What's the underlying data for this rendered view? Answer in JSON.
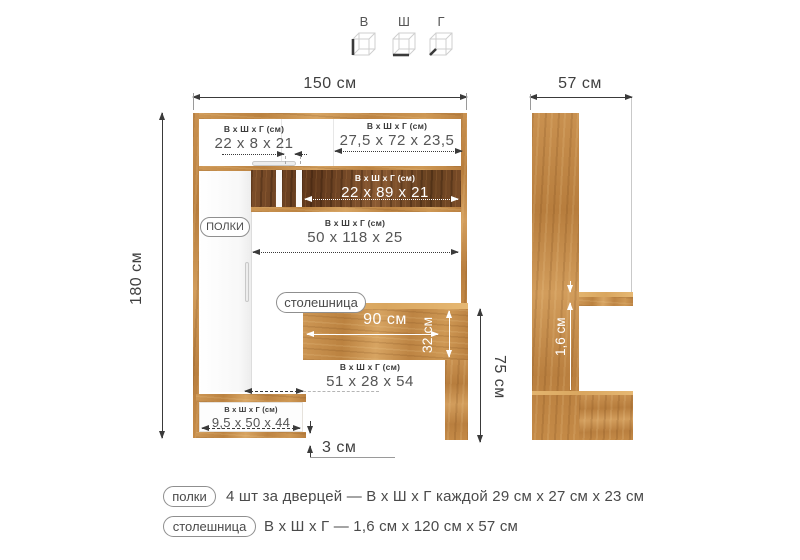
{
  "axis_icons": {
    "height": "В",
    "width": "Ш",
    "depth": "Г"
  },
  "common": {
    "dims_header": "В х Ш х Г (см)"
  },
  "front_view": {
    "total_width": "150 см",
    "total_height": "180 см",
    "top_left_cabinet": "22 x 8 x 21",
    "top_right_cabinet": "27,5 x 72 x 23,5",
    "niche_shelf": "22 x 89 x 21",
    "open_shelf": "50 x 118 x 25",
    "under_desk": "51 x 28 x 54",
    "drawer": "9,5 x 50 x 44",
    "desk_width": "90 см",
    "desk_depth": "32 см",
    "desk_height": "75 см",
    "plinth_height": "3 см",
    "shelves_tag": "ПОЛКИ",
    "desk_tag": "столешница"
  },
  "side_view": {
    "total_depth": "57 см",
    "top_thickness": "1,6 см"
  },
  "legend": {
    "items": [
      {
        "tag": "полки",
        "text": "4 шт за дверцей — В х Ш х Г каждой 29 см х 27 см х 23 см"
      },
      {
        "tag": "столешница",
        "text": "В х Ш х Г — 1,6 см х 120 см х 57 см"
      }
    ]
  },
  "colors": {
    "wood_light": "#c9914d",
    "wood_dark": "#6f4526",
    "text": "#3f3f3f",
    "pill_border": "#8f8f8f",
    "arrow_white": "#ffffff"
  }
}
